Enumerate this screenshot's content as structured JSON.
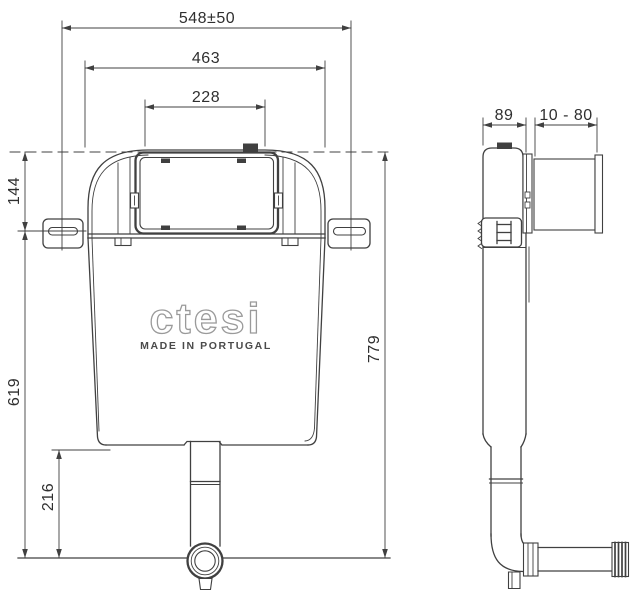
{
  "drawing": {
    "title_semantics": "concealed cistern technical drawing, front and side views",
    "front": {
      "dim_top_width": "548±50",
      "dim_tank_width": "463",
      "dim_panel_width": "228",
      "dim_bracket_height": "144",
      "dim_body_height": "619",
      "dim_outlet_height": "216",
      "dim_total_height": "779",
      "logo": "ctesi",
      "logo_subtitle": "MADE IN PORTUGAL"
    },
    "side": {
      "dim_depth": "89",
      "dim_adjust_range": "10 - 80"
    },
    "colors": {
      "line": "#404040",
      "text": "#2f2f2f",
      "logo_outline": "#9a9a9a",
      "background": "#ffffff"
    }
  }
}
